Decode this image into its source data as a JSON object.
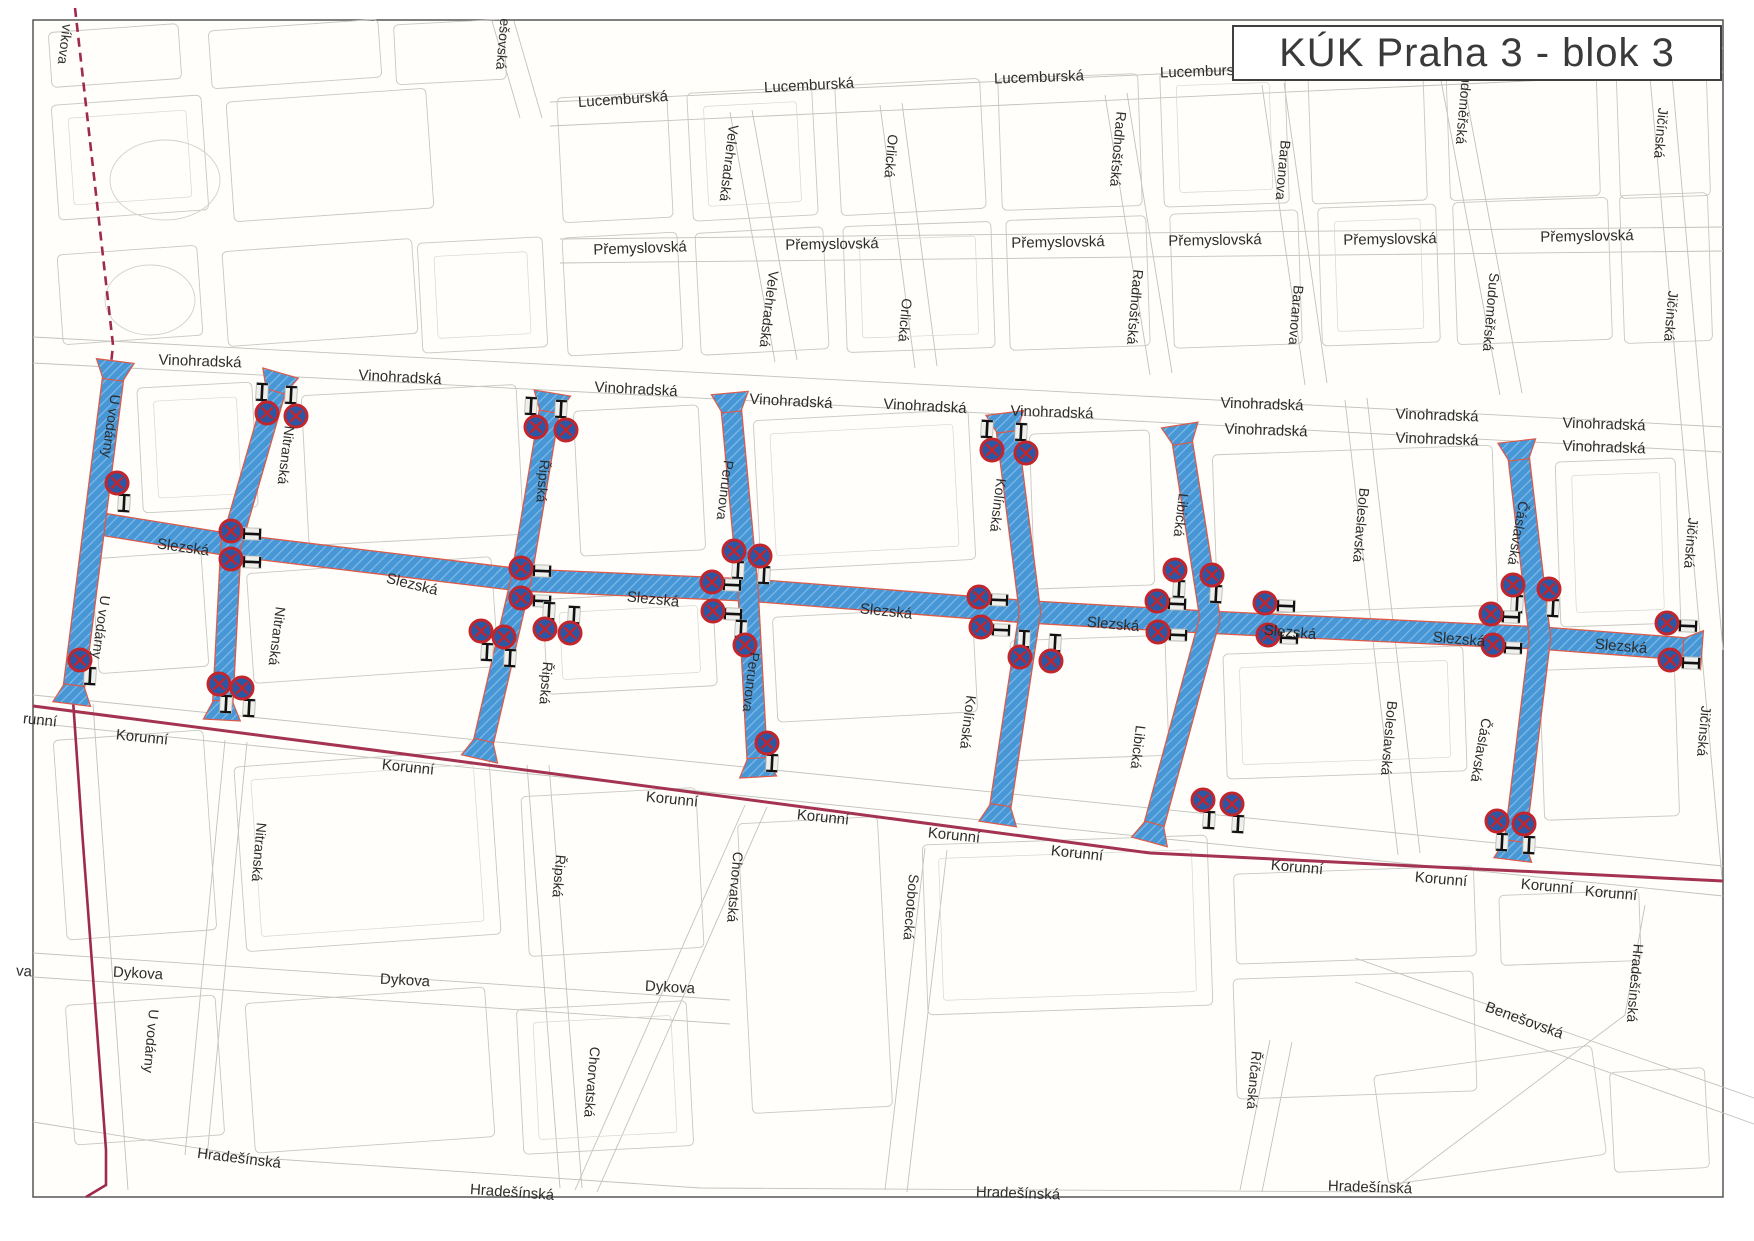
{
  "title": {
    "text": "KÚK Praha 3 - blok 3"
  },
  "map": {
    "colors": {
      "paper": "#fffefa",
      "frame": "#4a4a4a",
      "block_line": "#c8c8c3",
      "street_line": "#c2c2bd",
      "blue_fill": "#4796d6",
      "blue_hatch": "#7fbbe8",
      "red_casing": "#dd5a49",
      "boundary": "#9e2a4e",
      "korunni_line": "#a43352",
      "sign_ring": "#c2262c",
      "sign_fill": "#2b57a7",
      "post": "#111111",
      "label_text": "#2d2d2d"
    },
    "blue_streets": [
      {
        "name": "Slezská",
        "points": [
          [
            95,
            523
          ],
          [
            231,
            545
          ],
          [
            521,
            580
          ],
          [
            748,
            590
          ],
          [
            1030,
            612
          ],
          [
            1205,
            622
          ],
          [
            1540,
            638
          ],
          [
            1700,
            650
          ]
        ],
        "width": 21,
        "flare_start": false,
        "flare_end": true
      },
      {
        "name": "U vodárny",
        "points": [
          [
            115,
            363
          ],
          [
            95,
            520
          ],
          [
            72,
            702
          ]
        ],
        "width": 20,
        "flare_start": true,
        "flare_end": true
      },
      {
        "name": "Nitranská",
        "points": [
          [
            280,
            375
          ],
          [
            231,
            545
          ],
          [
            222,
            718
          ]
        ],
        "width": 19,
        "flare_start": true,
        "flare_end": true
      },
      {
        "name": "Řipská",
        "points": [
          [
            552,
            395
          ],
          [
            521,
            580
          ],
          [
            480,
            757
          ]
        ],
        "width": 19,
        "flare_start": true,
        "flare_end": true
      },
      {
        "name": "Perunova",
        "points": [
          [
            730,
            395
          ],
          [
            748,
            590
          ],
          [
            758,
            775
          ]
        ],
        "width": 19,
        "flare_start": true,
        "flare_end": true
      },
      {
        "name": "Kolínská",
        "points": [
          [
            1005,
            415
          ],
          [
            1030,
            612
          ],
          [
            998,
            822
          ]
        ],
        "width": 20,
        "flare_start": true,
        "flare_end": true
      },
      {
        "name": "Libická",
        "points": [
          [
            1180,
            427
          ],
          [
            1210,
            618
          ],
          [
            1150,
            840
          ]
        ],
        "width": 19,
        "flare_start": true,
        "flare_end": true
      },
      {
        "name": "Čáslavská",
        "points": [
          [
            1517,
            443
          ],
          [
            1540,
            638
          ],
          [
            1513,
            858
          ]
        ],
        "width": 20,
        "flare_start": true,
        "flare_end": true
      }
    ],
    "boundary_dashed": [
      [
        75,
        8
      ],
      [
        113,
        345
      ],
      [
        95,
        520
      ],
      [
        73,
        700
      ]
    ],
    "boundary_solid": [
      [
        73,
        700
      ],
      [
        82,
        830
      ],
      [
        106,
        1150
      ],
      [
        106,
        1185
      ],
      [
        86,
        1197
      ]
    ],
    "korunni_line": [
      [
        33,
        706
      ],
      [
        450,
        760
      ],
      [
        1150,
        853
      ],
      [
        1723,
        881
      ]
    ],
    "signs": [
      [
        117,
        483,
        124,
        503,
        3
      ],
      [
        80,
        660,
        90,
        676,
        3
      ],
      [
        267,
        413,
        262,
        392,
        3
      ],
      [
        296,
        416,
        291,
        395,
        3
      ],
      [
        231,
        531,
        252,
        534,
        92
      ],
      [
        231,
        559,
        252,
        562,
        92
      ],
      [
        219,
        684,
        226,
        704,
        3
      ],
      [
        242,
        688,
        249,
        708,
        3
      ],
      [
        536,
        427,
        531,
        406,
        3
      ],
      [
        566,
        430,
        561,
        409,
        3
      ],
      [
        521,
        568,
        542,
        571,
        92
      ],
      [
        521,
        598,
        542,
        601,
        92
      ],
      [
        545,
        629,
        549,
        611,
        3
      ],
      [
        570,
        633,
        574,
        615,
        3
      ],
      [
        481,
        631,
        487,
        652,
        3
      ],
      [
        504,
        637,
        510,
        658,
        3
      ],
      [
        734,
        551,
        738,
        570,
        3
      ],
      [
        760,
        556,
        764,
        575,
        3
      ],
      [
        712,
        582,
        732,
        585,
        92
      ],
      [
        713,
        611,
        733,
        614,
        92
      ],
      [
        745,
        645,
        741,
        629,
        3
      ],
      [
        767,
        743,
        772,
        763,
        3
      ],
      [
        992,
        450,
        987,
        429,
        3
      ],
      [
        1026,
        453,
        1021,
        432,
        3
      ],
      [
        979,
        597,
        999,
        600,
        92
      ],
      [
        981,
        627,
        1001,
        630,
        92
      ],
      [
        1020,
        657,
        1024,
        639,
        3
      ],
      [
        1051,
        661,
        1055,
        643,
        3
      ],
      [
        1175,
        570,
        1179,
        589,
        3
      ],
      [
        1212,
        575,
        1216,
        594,
        3
      ],
      [
        1157,
        601,
        1177,
        604,
        92
      ],
      [
        1158,
        632,
        1178,
        635,
        92
      ],
      [
        1203,
        800,
        1209,
        820,
        3
      ],
      [
        1232,
        804,
        1238,
        824,
        3
      ],
      [
        1265,
        603,
        1286,
        606,
        92
      ],
      [
        1268,
        635,
        1289,
        638,
        92
      ],
      [
        1513,
        585,
        1517,
        604,
        3
      ],
      [
        1549,
        589,
        1553,
        608,
        3
      ],
      [
        1491,
        614,
        1511,
        617,
        92
      ],
      [
        1493,
        645,
        1513,
        648,
        92
      ],
      [
        1497,
        821,
        1502,
        842,
        3
      ],
      [
        1524,
        824,
        1529,
        845,
        3
      ],
      [
        1667,
        623,
        1688,
        626,
        92
      ],
      [
        1670,
        660,
        1691,
        663,
        92
      ]
    ],
    "labels": [
      {
        "t": "Lucemburská",
        "x": 623,
        "y": 100,
        "r": -4,
        "s": 15
      },
      {
        "t": "Lucemburská",
        "x": 809,
        "y": 86,
        "r": -3,
        "s": 15
      },
      {
        "t": "Lucemburská",
        "x": 1039,
        "y": 78,
        "r": -2,
        "s": 15
      },
      {
        "t": "Lucemburská",
        "x": 1205,
        "y": 72,
        "r": -2,
        "s": 15
      },
      {
        "t": "Přemyslovská",
        "x": 640,
        "y": 249,
        "r": -2,
        "s": 15
      },
      {
        "t": "Přemyslovská",
        "x": 832,
        "y": 245,
        "r": -1,
        "s": 15
      },
      {
        "t": "Přemyslovská",
        "x": 1058,
        "y": 243,
        "r": -1,
        "s": 15
      },
      {
        "t": "Přemyslovská",
        "x": 1215,
        "y": 241,
        "r": -1,
        "s": 15
      },
      {
        "t": "Přemyslovská",
        "x": 1390,
        "y": 240,
        "r": -1,
        "s": 15
      },
      {
        "t": "Přemyslovská",
        "x": 1587,
        "y": 237,
        "r": -1,
        "s": 15
      },
      {
        "t": "Vinohradská",
        "x": 200,
        "y": 362,
        "r": 2,
        "s": 15
      },
      {
        "t": "Vinohradská",
        "x": 400,
        "y": 378,
        "r": 3,
        "s": 15
      },
      {
        "t": "Vinohradská",
        "x": 636,
        "y": 390,
        "r": 3,
        "s": 15
      },
      {
        "t": "Vinohradská",
        "x": 791,
        "y": 402,
        "r": 3,
        "s": 15
      },
      {
        "t": "Vinohradská",
        "x": 925,
        "y": 407,
        "r": 3,
        "s": 15
      },
      {
        "t": "Vinohradská",
        "x": 1052,
        "y": 413,
        "r": 2,
        "s": 15
      },
      {
        "t": "Vinohradská",
        "x": 1262,
        "y": 405,
        "r": 2,
        "s": 15
      },
      {
        "t": "Vinohradská",
        "x": 1266,
        "y": 431,
        "r": 2,
        "s": 15
      },
      {
        "t": "Vinohradská",
        "x": 1437,
        "y": 416,
        "r": 2,
        "s": 15
      },
      {
        "t": "Vinohradská",
        "x": 1437,
        "y": 440,
        "r": 2,
        "s": 15
      },
      {
        "t": "Vinohradská",
        "x": 1604,
        "y": 425,
        "r": 2,
        "s": 15
      },
      {
        "t": "Vinohradská",
        "x": 1604,
        "y": 448,
        "r": 2,
        "s": 15
      },
      {
        "t": "Slezská",
        "x": 183,
        "y": 548,
        "r": 8,
        "s": 15
      },
      {
        "t": "Slezská",
        "x": 412,
        "y": 585,
        "r": 14,
        "s": 15
      },
      {
        "t": "Slezská",
        "x": 653,
        "y": 600,
        "r": 6,
        "s": 15
      },
      {
        "t": "Slezská",
        "x": 886,
        "y": 612,
        "r": 6,
        "s": 15
      },
      {
        "t": "Slezská",
        "x": 1113,
        "y": 625,
        "r": 5,
        "s": 15
      },
      {
        "t": "Slezská",
        "x": 1290,
        "y": 633,
        "r": 5,
        "s": 15
      },
      {
        "t": "Slezská",
        "x": 1459,
        "y": 640,
        "r": 5,
        "s": 15
      },
      {
        "t": "Slezská",
        "x": 1621,
        "y": 647,
        "r": 5,
        "s": 15
      },
      {
        "t": "runní",
        "x": 40,
        "y": 721,
        "r": 6,
        "s": 15
      },
      {
        "t": "Korunní",
        "x": 142,
        "y": 738,
        "r": 6,
        "s": 15
      },
      {
        "t": "Korunní",
        "x": 408,
        "y": 768,
        "r": 6,
        "s": 15
      },
      {
        "t": "Korunní",
        "x": 672,
        "y": 800,
        "r": 6,
        "s": 15
      },
      {
        "t": "Korunní",
        "x": 823,
        "y": 818,
        "r": 6,
        "s": 15
      },
      {
        "t": "Korunní",
        "x": 954,
        "y": 836,
        "r": 6,
        "s": 15
      },
      {
        "t": "Korunní",
        "x": 1077,
        "y": 854,
        "r": 6,
        "s": 15
      },
      {
        "t": "Korunní",
        "x": 1297,
        "y": 868,
        "r": 5,
        "s": 15
      },
      {
        "t": "Korunní",
        "x": 1441,
        "y": 880,
        "r": 5,
        "s": 15
      },
      {
        "t": "Korunní",
        "x": 1547,
        "y": 887,
        "r": 5,
        "s": 15
      },
      {
        "t": "Korunní",
        "x": 1611,
        "y": 894,
        "r": 5,
        "s": 15
      },
      {
        "t": "va",
        "x": 24,
        "y": 972,
        "r": 3,
        "s": 15
      },
      {
        "t": "Dykova",
        "x": 138,
        "y": 974,
        "r": 3,
        "s": 15
      },
      {
        "t": "Dykova",
        "x": 405,
        "y": 981,
        "r": 3,
        "s": 15
      },
      {
        "t": "Dykova",
        "x": 670,
        "y": 988,
        "r": 3,
        "s": 15
      },
      {
        "t": "Hradešínská",
        "x": 239,
        "y": 1159,
        "r": 7,
        "s": 15
      },
      {
        "t": "Hradešínská",
        "x": 512,
        "y": 1193,
        "r": 4,
        "s": 15
      },
      {
        "t": "Hradešínská",
        "x": 1018,
        "y": 1194,
        "r": 2,
        "s": 15
      },
      {
        "t": "Hradešínská",
        "x": 1370,
        "y": 1188,
        "r": 2,
        "s": 15
      },
      {
        "t": "Hradešínská",
        "x": 1634,
        "y": 983,
        "r": 95,
        "s": 14
      },
      {
        "t": "Benešovská",
        "x": 1524,
        "y": 1021,
        "r": 20,
        "s": 15
      },
      {
        "t": "víkova",
        "x": 64,
        "y": 44,
        "r": 97,
        "s": 14
      },
      {
        "t": "ešovská",
        "x": 502,
        "y": 44,
        "r": 95,
        "s": 14
      },
      {
        "t": "Velehradská",
        "x": 728,
        "y": 163,
        "r": 97,
        "s": 14
      },
      {
        "t": "Velehradská",
        "x": 768,
        "y": 309,
        "r": 97,
        "s": 14
      },
      {
        "t": "Orlická",
        "x": 890,
        "y": 156,
        "r": 95,
        "s": 14
      },
      {
        "t": "Orlická",
        "x": 904,
        "y": 320,
        "r": 95,
        "s": 14
      },
      {
        "t": "Radhošťská",
        "x": 1117,
        "y": 149,
        "r": 95,
        "s": 14
      },
      {
        "t": "Radhošťská",
        "x": 1134,
        "y": 307,
        "r": 95,
        "s": 14
      },
      {
        "t": "Baranova",
        "x": 1282,
        "y": 170,
        "r": 95,
        "s": 14
      },
      {
        "t": "Baranova",
        "x": 1295,
        "y": 315,
        "r": 95,
        "s": 14
      },
      {
        "t": "Sudoměřská",
        "x": 1463,
        "y": 105,
        "r": 95,
        "s": 14
      },
      {
        "t": "Sudoměřská",
        "x": 1490,
        "y": 312,
        "r": 95,
        "s": 14
      },
      {
        "t": "Jičínská",
        "x": 1660,
        "y": 133,
        "r": 95,
        "s": 14
      },
      {
        "t": "Jičínská",
        "x": 1670,
        "y": 316,
        "r": 95,
        "s": 14
      },
      {
        "t": "Jičínská",
        "x": 1690,
        "y": 543,
        "r": 95,
        "s": 14
      },
      {
        "t": "Jičínská",
        "x": 1703,
        "y": 731,
        "r": 95,
        "s": 14
      },
      {
        "t": "Boleslavská",
        "x": 1360,
        "y": 525,
        "r": 95,
        "s": 14
      },
      {
        "t": "Boleslavská",
        "x": 1388,
        "y": 738,
        "r": 95,
        "s": 14
      },
      {
        "t": "U vodárny",
        "x": 110,
        "y": 426,
        "r": 98,
        "s": 14
      },
      {
        "t": "U vodárny",
        "x": 100,
        "y": 627,
        "r": 98,
        "s": 14
      },
      {
        "t": "U vodárny",
        "x": 150,
        "y": 1041,
        "r": 95,
        "s": 14
      },
      {
        "t": "Nitranská",
        "x": 285,
        "y": 455,
        "r": 97,
        "s": 14
      },
      {
        "t": "Nitranská",
        "x": 276,
        "y": 636,
        "r": 97,
        "s": 14
      },
      {
        "t": "Nitranská",
        "x": 258,
        "y": 852,
        "r": 95,
        "s": 14
      },
      {
        "t": "Řipská",
        "x": 542,
        "y": 481,
        "r": 95,
        "s": 14
      },
      {
        "t": "Řipská",
        "x": 545,
        "y": 683,
        "r": 95,
        "s": 14
      },
      {
        "t": "Řipská",
        "x": 558,
        "y": 876,
        "r": 95,
        "s": 14
      },
      {
        "t": "Perunova",
        "x": 724,
        "y": 490,
        "r": 97,
        "s": 14
      },
      {
        "t": "Perunova",
        "x": 750,
        "y": 682,
        "r": 97,
        "s": 14
      },
      {
        "t": "Kolínská",
        "x": 997,
        "y": 505,
        "r": 97,
        "s": 14
      },
      {
        "t": "Kolínská",
        "x": 967,
        "y": 722,
        "r": 97,
        "s": 14
      },
      {
        "t": "Libická",
        "x": 1180,
        "y": 515,
        "r": 97,
        "s": 14
      },
      {
        "t": "Libická",
        "x": 1137,
        "y": 747,
        "r": 97,
        "s": 14
      },
      {
        "t": "Čáslavská",
        "x": 1517,
        "y": 533,
        "r": 100,
        "s": 14
      },
      {
        "t": "Čáslavská",
        "x": 1480,
        "y": 750,
        "r": 100,
        "s": 14
      },
      {
        "t": "Chorvatská",
        "x": 734,
        "y": 887,
        "r": 95,
        "s": 14
      },
      {
        "t": "Chorvatská",
        "x": 591,
        "y": 1082,
        "r": 95,
        "s": 14
      },
      {
        "t": "Sobotecká",
        "x": 910,
        "y": 907,
        "r": 95,
        "s": 14
      },
      {
        "t": "Říčanská",
        "x": 1253,
        "y": 1080,
        "r": 95,
        "s": 14
      }
    ]
  }
}
